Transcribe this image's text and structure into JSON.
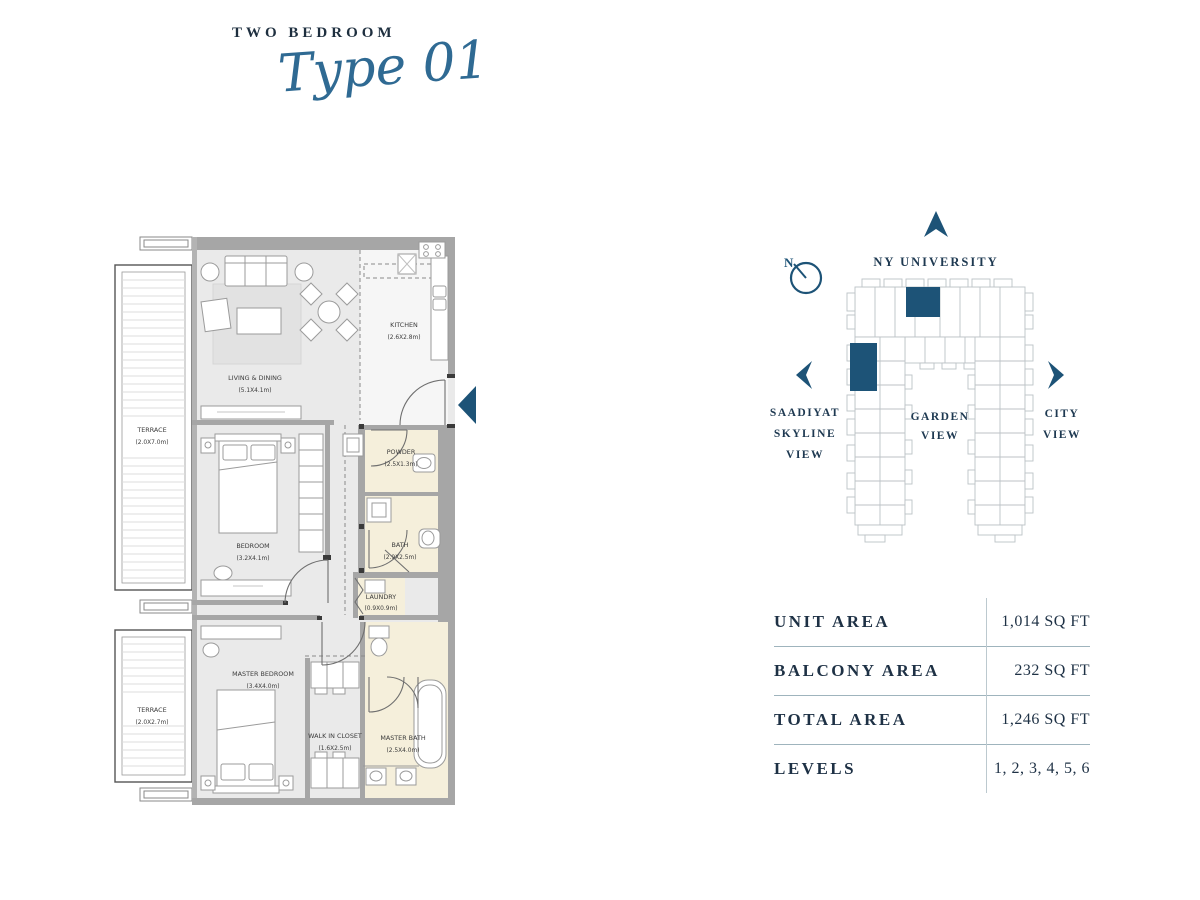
{
  "header": {
    "category": "TWO BEDROOM",
    "type_label": "Type 01"
  },
  "floorplan": {
    "rooms": [
      {
        "name": "LIVING & DINING",
        "dims": "(5.1X4.1m)"
      },
      {
        "name": "KITCHEN",
        "dims": "(2.6X2.8m)"
      },
      {
        "name": "TERRACE",
        "dims": "(2.0X7.0m)"
      },
      {
        "name": "BEDROOM",
        "dims": "(3.2X4.1m)"
      },
      {
        "name": "POWDER",
        "dims": "(2.5X1.3m)"
      },
      {
        "name": "BATH",
        "dims": "(2.9X2.5m)"
      },
      {
        "name": "LAUNDRY",
        "dims": "(0.9X0.9m)"
      },
      {
        "name": "TERRACE",
        "dims": "(2.0X2.7m)"
      },
      {
        "name": "MASTER BEDROOM",
        "dims": "(3.4X4.0m)"
      },
      {
        "name": "WALK IN CLOSET",
        "dims": "(1.6X2.5m)"
      },
      {
        "name": "MASTER BATH",
        "dims": "(2.5X4.0m)"
      }
    ]
  },
  "siteplan": {
    "north_label": "N",
    "top_label": "NY UNIVERSITY",
    "left_label_lines": [
      "SAADIYAT",
      "SKYLINE",
      "VIEW"
    ],
    "center_label_lines": [
      "GARDEN",
      "VIEW"
    ],
    "right_label_lines": [
      "CITY",
      "VIEW"
    ]
  },
  "spec_table": {
    "rows": [
      {
        "label": "UNIT AREA",
        "value": "1,014 SQ FT"
      },
      {
        "label": "BALCONY AREA",
        "value": "232 SQ FT"
      },
      {
        "label": "TOTAL AREA",
        "value": "1,246 SQ FT"
      },
      {
        "label": "LEVELS",
        "value": "1, 2, 3, 4, 5, 6"
      }
    ]
  },
  "colors": {
    "accent": "#1d5377",
    "heading_text": "#1e2f3f",
    "plan_wall": "#a6a6a6",
    "plan_floor": "#eaeaea",
    "wet_floor": "#f5efdb"
  }
}
